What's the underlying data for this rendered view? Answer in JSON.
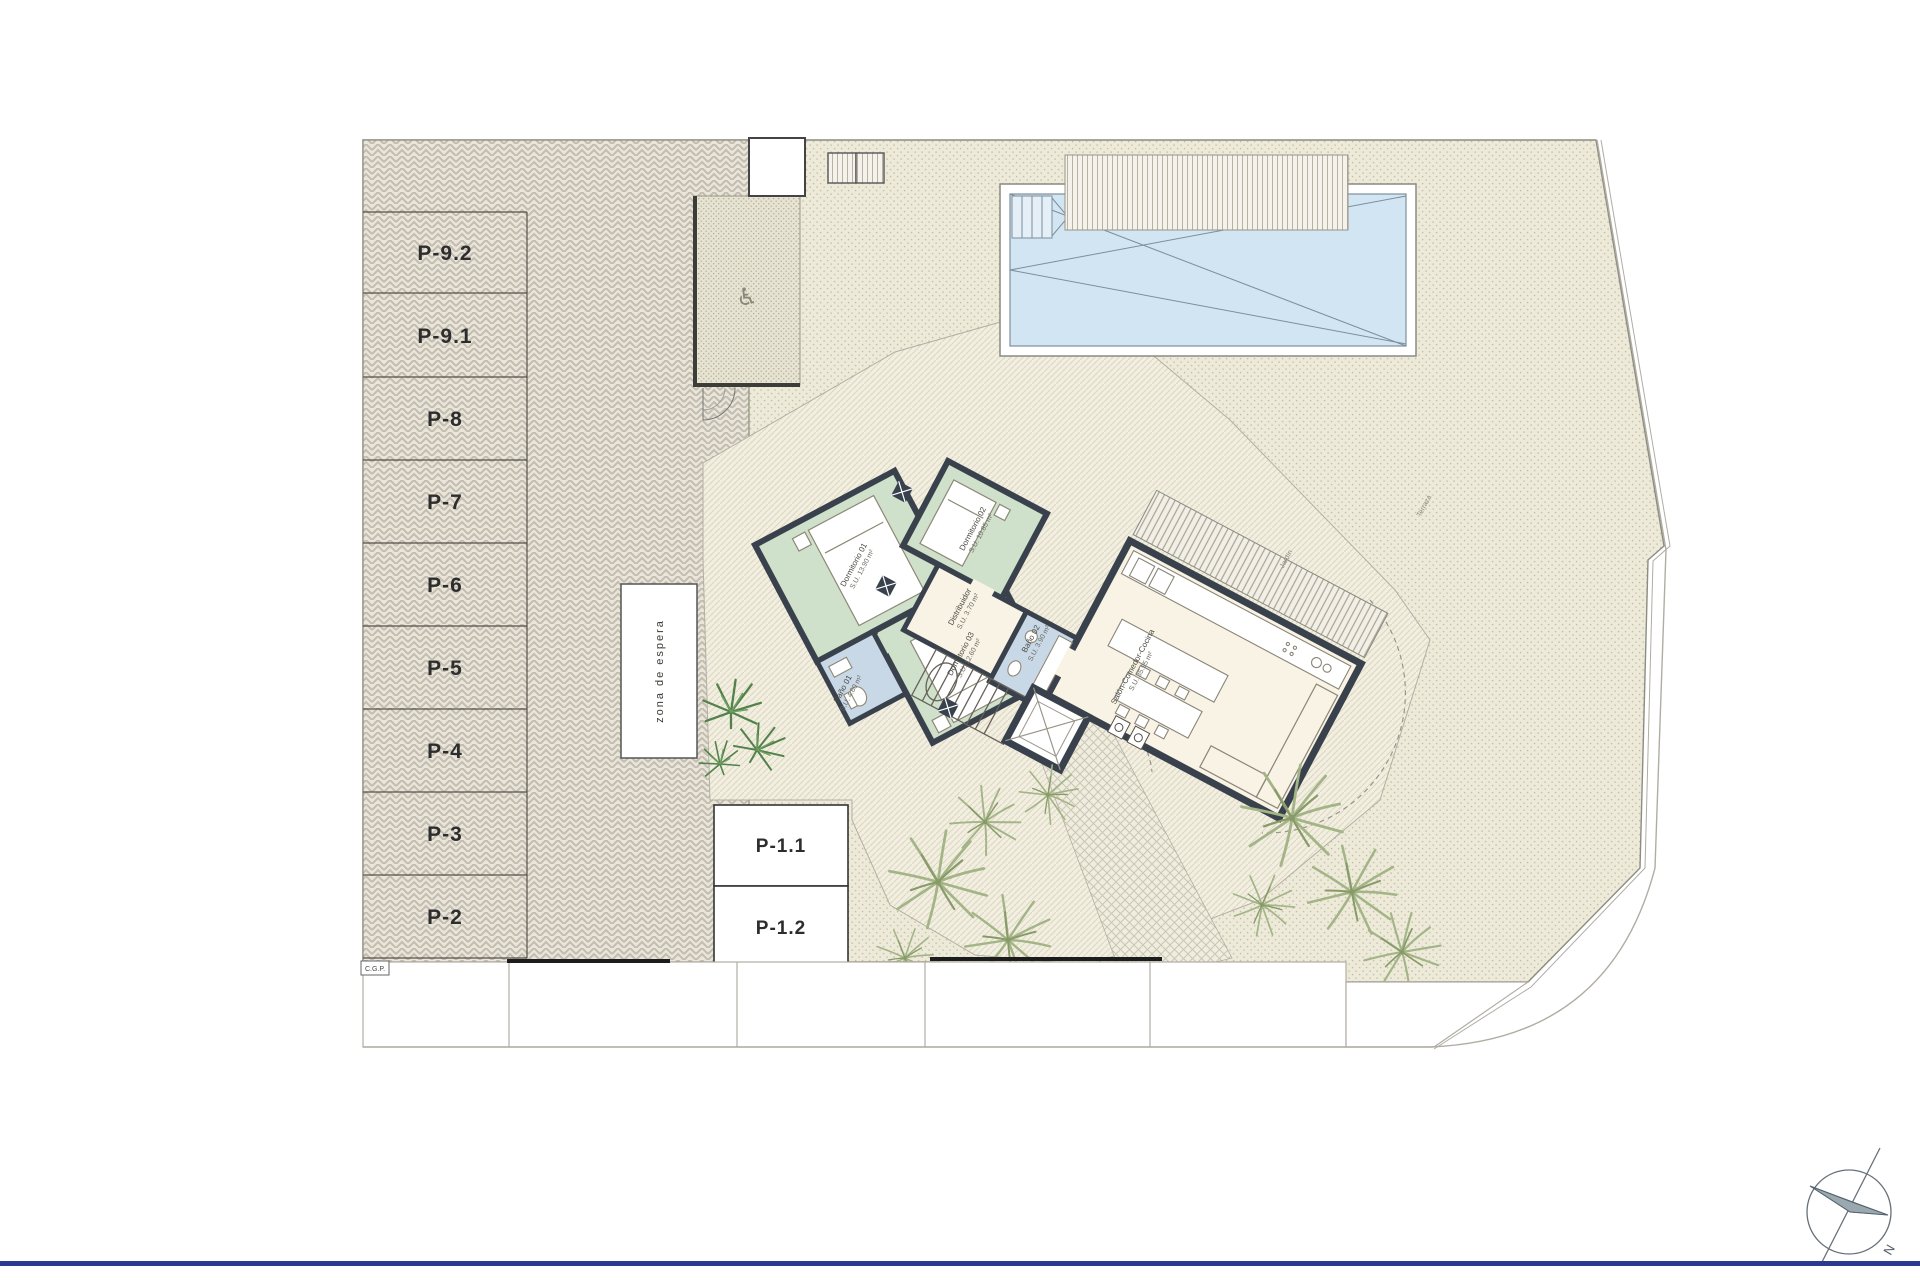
{
  "plan": {
    "title": "site-plan-ground-floor",
    "parking": {
      "stalls": [
        "P-9.2",
        "P-9.1",
        "P-8",
        "P-7",
        "P-6",
        "P-5",
        "P-4",
        "P-3",
        "P-2"
      ],
      "front_stalls": [
        "P-1.1",
        "P-1.2"
      ]
    },
    "rooms": {
      "d1": {
        "name": "Dormitorio 01",
        "area": "S.U. 13.90 m²"
      },
      "d2": {
        "name": "Dormitorio 02",
        "area": "S.U. 10.85 m²"
      },
      "d3": {
        "name": "Dormitorio 03",
        "area": "S.U. 12.60 m²"
      },
      "b1": {
        "name": "Baño 01",
        "area": "S.U. 4.60 m²"
      },
      "b2": {
        "name": "Baño 02",
        "area": "S.U. 3.90 m²"
      },
      "dist": {
        "name": "Distribuidor",
        "area": "S.U. 3.70 m²"
      },
      "salon": {
        "name": "Salón-Comedor-Cocina",
        "area": "S.U. 35.95 m²"
      }
    },
    "labels": {
      "waiting_zone": "zona de espera",
      "cgp": "C.G.P.",
      "north": "N",
      "garden_1": "Terraza",
      "garden_2": "Jardín"
    },
    "icons": {
      "accessible": "♿"
    },
    "colors": {
      "wall": "#39424c",
      "bedroom_green": "#cfe0cb",
      "bath_blue": "#c9d8e7",
      "living_cream": "#f8f3e4",
      "pool_blue": "#d2e5f3",
      "bottom_rule_blue": "#2b3990"
    }
  }
}
